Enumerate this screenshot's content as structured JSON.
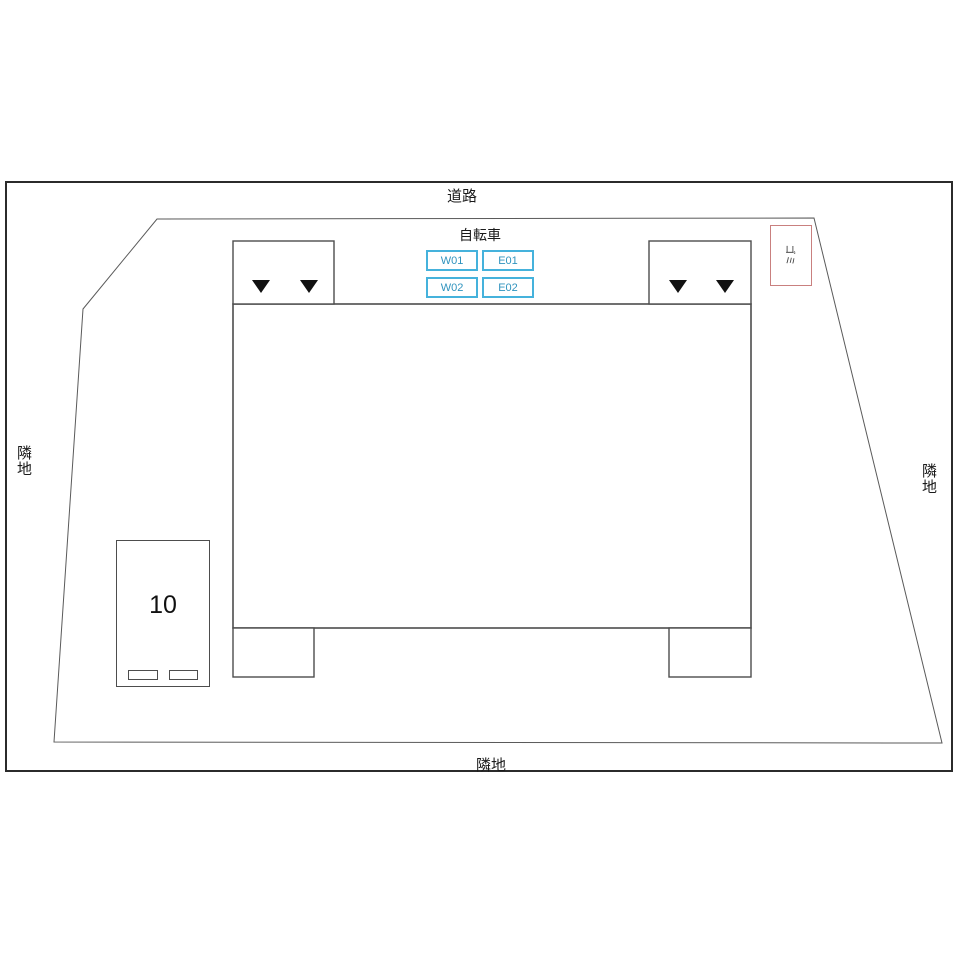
{
  "plan": {
    "title": "site-plan",
    "road_label": "道路",
    "neighbor_left_label": "隣地",
    "neighbor_right_label": "隣地",
    "neighbor_bottom_label": "隣地",
    "bicycle": {
      "title": "自転車",
      "slots": [
        "W01",
        "E01",
        "W02",
        "E02"
      ]
    },
    "garbage_label": "ゴミ",
    "parking": {
      "space_number": "10",
      "wheel_stops": 2
    },
    "entrance_markers": {
      "icon": "triangle-down",
      "glyph": "▼",
      "count": 4
    },
    "colors": {
      "slot_border": "#45b2dc",
      "slot_text": "#2f93be",
      "garbage_border": "#c9807f",
      "building_line": "#4d4d4d",
      "boundary_line": "#5a5a5a",
      "frame": "#2b2b2b",
      "marker": "#111111"
    }
  }
}
